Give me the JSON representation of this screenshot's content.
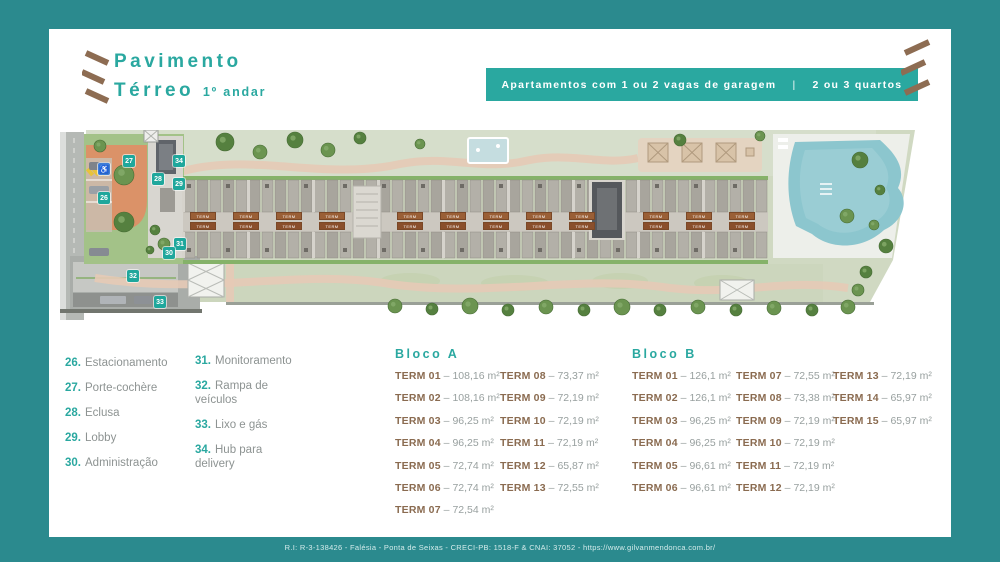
{
  "colors": {
    "background_teal": "#2b8a8e",
    "accent_teal": "#2aa8a0",
    "badge_teal": "#1fa79c",
    "brown": "#8a6b50",
    "gray_text": "#8d9392",
    "orange_courtyard": "#db9268",
    "pool_blue": "#8cc6ce"
  },
  "title": {
    "line1": "Pavimento",
    "line2": "Térreo",
    "suffix": "1º andar"
  },
  "banner": {
    "left": "Apartamentos com 1 ou 2 vagas de garagem",
    "separator": "|",
    "right": "2 ou 3 quartos"
  },
  "legend": {
    "items_col1": [
      {
        "num": "26.",
        "label": "Estacionamento"
      },
      {
        "num": "27.",
        "label": "Porte-cochère"
      },
      {
        "num": "28.",
        "label": "Eclusa"
      },
      {
        "num": "29.",
        "label": "Lobby"
      },
      {
        "num": "30.",
        "label": "Administração"
      }
    ],
    "items_col2": [
      {
        "num": "31.",
        "label": "Monitoramento"
      },
      {
        "num": "32.",
        "label": "Rampa de veículos"
      },
      {
        "num": "33.",
        "label": "Lixo e gás"
      },
      {
        "num": "34.",
        "label": "Hub para delivery"
      }
    ]
  },
  "bloco_a": {
    "title": "Bloco A",
    "col1": [
      {
        "term": "TERM 01",
        "area": "108,16 m²"
      },
      {
        "term": "TERM 02",
        "area": "108,16 m²"
      },
      {
        "term": "TERM 03",
        "area": "96,25 m²"
      },
      {
        "term": "TERM 04",
        "area": "96,25 m²"
      },
      {
        "term": "TERM 05",
        "area": "72,74 m²"
      },
      {
        "term": "TERM 06",
        "area": "72,74 m²"
      },
      {
        "term": "TERM 07",
        "area": "72,54 m²"
      }
    ],
    "col2": [
      {
        "term": "TERM 08",
        "area": "73,37 m²"
      },
      {
        "term": "TERM 09",
        "area": "72,19 m²"
      },
      {
        "term": "TERM 10",
        "area": "72,19 m²"
      },
      {
        "term": "TERM 11",
        "area": "72,19 m²"
      },
      {
        "term": "TERM 12",
        "area": "65,87 m²"
      },
      {
        "term": "TERM 13",
        "area": "72,55 m²"
      }
    ]
  },
  "bloco_b": {
    "title": "Bloco B",
    "col1": [
      {
        "term": "TERM 01",
        "area": "126,1 m²"
      },
      {
        "term": "TERM 02",
        "area": "126,1 m²"
      },
      {
        "term": "TERM 03",
        "area": "96,25 m²"
      },
      {
        "term": "TERM 04",
        "area": "96,25 m²"
      },
      {
        "term": "TERM 05",
        "area": "96,61 m²"
      },
      {
        "term": "TERM 06",
        "area": "96,61 m²"
      }
    ],
    "col2": [
      {
        "term": "TERM 07",
        "area": "72,55 m²"
      },
      {
        "term": "TERM 08",
        "area": "73,38 m²"
      },
      {
        "term": "TERM 09",
        "area": "72,19 m²"
      },
      {
        "term": "TERM 10",
        "area": "72,19 m²"
      },
      {
        "term": "TERM 11",
        "area": "72,19 m²"
      },
      {
        "term": "TERM 12",
        "area": "72,19 m²"
      }
    ],
    "col3": [
      {
        "term": "TERM 13",
        "area": "72,19 m²"
      },
      {
        "term": "TERM 14",
        "area": "65,97 m²"
      },
      {
        "term": "TERM 15",
        "area": "65,97 m²"
      }
    ]
  },
  "site_plan": {
    "term_bar_label": "TERM",
    "badges": [
      {
        "label": "27",
        "x": 63,
        "y": 25
      },
      {
        "label": "28",
        "x": 92,
        "y": 43
      },
      {
        "label": "34",
        "x": 113,
        "y": 25
      },
      {
        "label": "29",
        "x": 113,
        "y": 48
      },
      {
        "label": "26",
        "x": 38,
        "y": 62
      },
      {
        "label": "31",
        "x": 114,
        "y": 108
      },
      {
        "label": "30",
        "x": 103,
        "y": 117
      },
      {
        "label": "32",
        "x": 67,
        "y": 140
      },
      {
        "label": "33",
        "x": 94,
        "y": 166
      }
    ],
    "accessible_badge": {
      "symbol": "♿",
      "x": 38,
      "y": 33
    }
  },
  "footer": {
    "text": "R.I: R-3-138426 - Falésia - Ponta de Seixas - CRECI-PB: 1518-F & CNAI: 37052 - https://www.gilvanmendonca.com.br/"
  }
}
